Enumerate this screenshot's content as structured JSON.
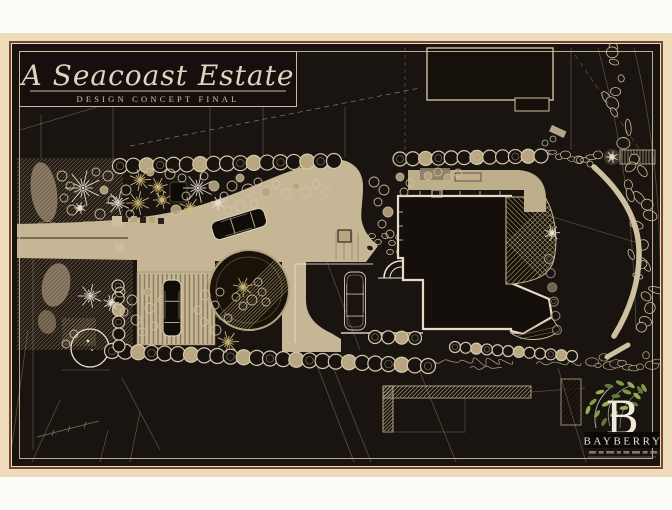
{
  "artwork": {
    "title": "A Seacoast Estate",
    "subtitle": "DESIGN CONCEPT FINAL"
  },
  "logo": {
    "initial": "B",
    "brand": "BAYBERRY"
  },
  "palette": {
    "page_bg": "#fdfcf8",
    "mat": "#ecdcbc",
    "frame_line": "#7a4632",
    "plan_bg": "#1a1410",
    "ink": "#d8ccb0",
    "tan": "#c6b695",
    "tan_dark": "#a3906c",
    "gold": "#d4be7e",
    "white_line": "#e9e2d0",
    "leaf_green": "#7f9c45"
  }
}
